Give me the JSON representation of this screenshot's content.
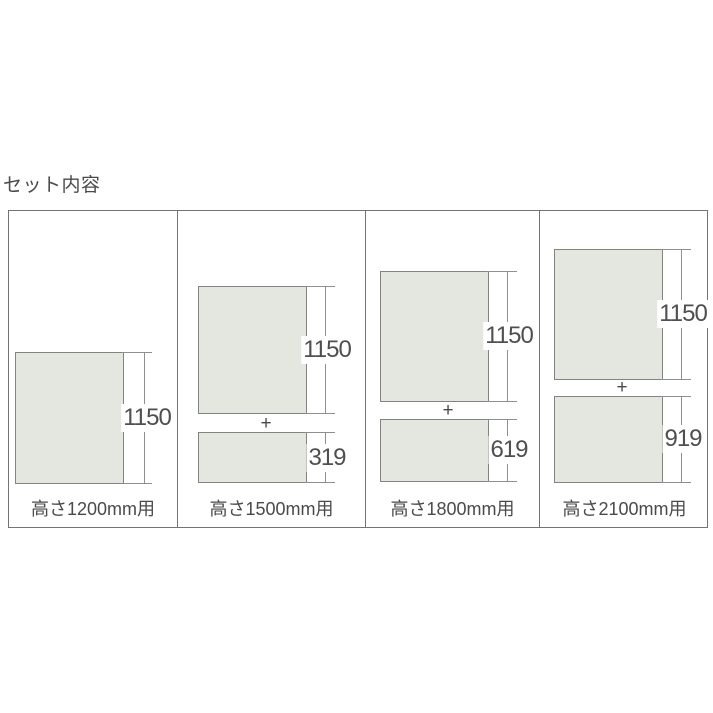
{
  "page": {
    "title": "セット内容",
    "background": "#ffffff"
  },
  "colors": {
    "panel_fill": "#e4e6e0",
    "panel_border": "#82857f",
    "table_border": "#737373",
    "dimension_line": "#8f8f8f",
    "text": "#4a4a4a"
  },
  "symbols": {
    "plus": "+"
  },
  "columns": [
    {
      "label": "高さ1200mm用",
      "panels": [
        {
          "height_mm": "1150"
        }
      ]
    },
    {
      "label": "高さ1500mm用",
      "panels": [
        {
          "height_mm": "1150"
        },
        {
          "height_mm": "319"
        }
      ]
    },
    {
      "label": "高さ1800mm用",
      "panels": [
        {
          "height_mm": "1150"
        },
        {
          "height_mm": "619"
        }
      ]
    },
    {
      "label": "高さ2100mm用",
      "panels": [
        {
          "height_mm": "1150"
        },
        {
          "height_mm": "919"
        }
      ]
    }
  ]
}
